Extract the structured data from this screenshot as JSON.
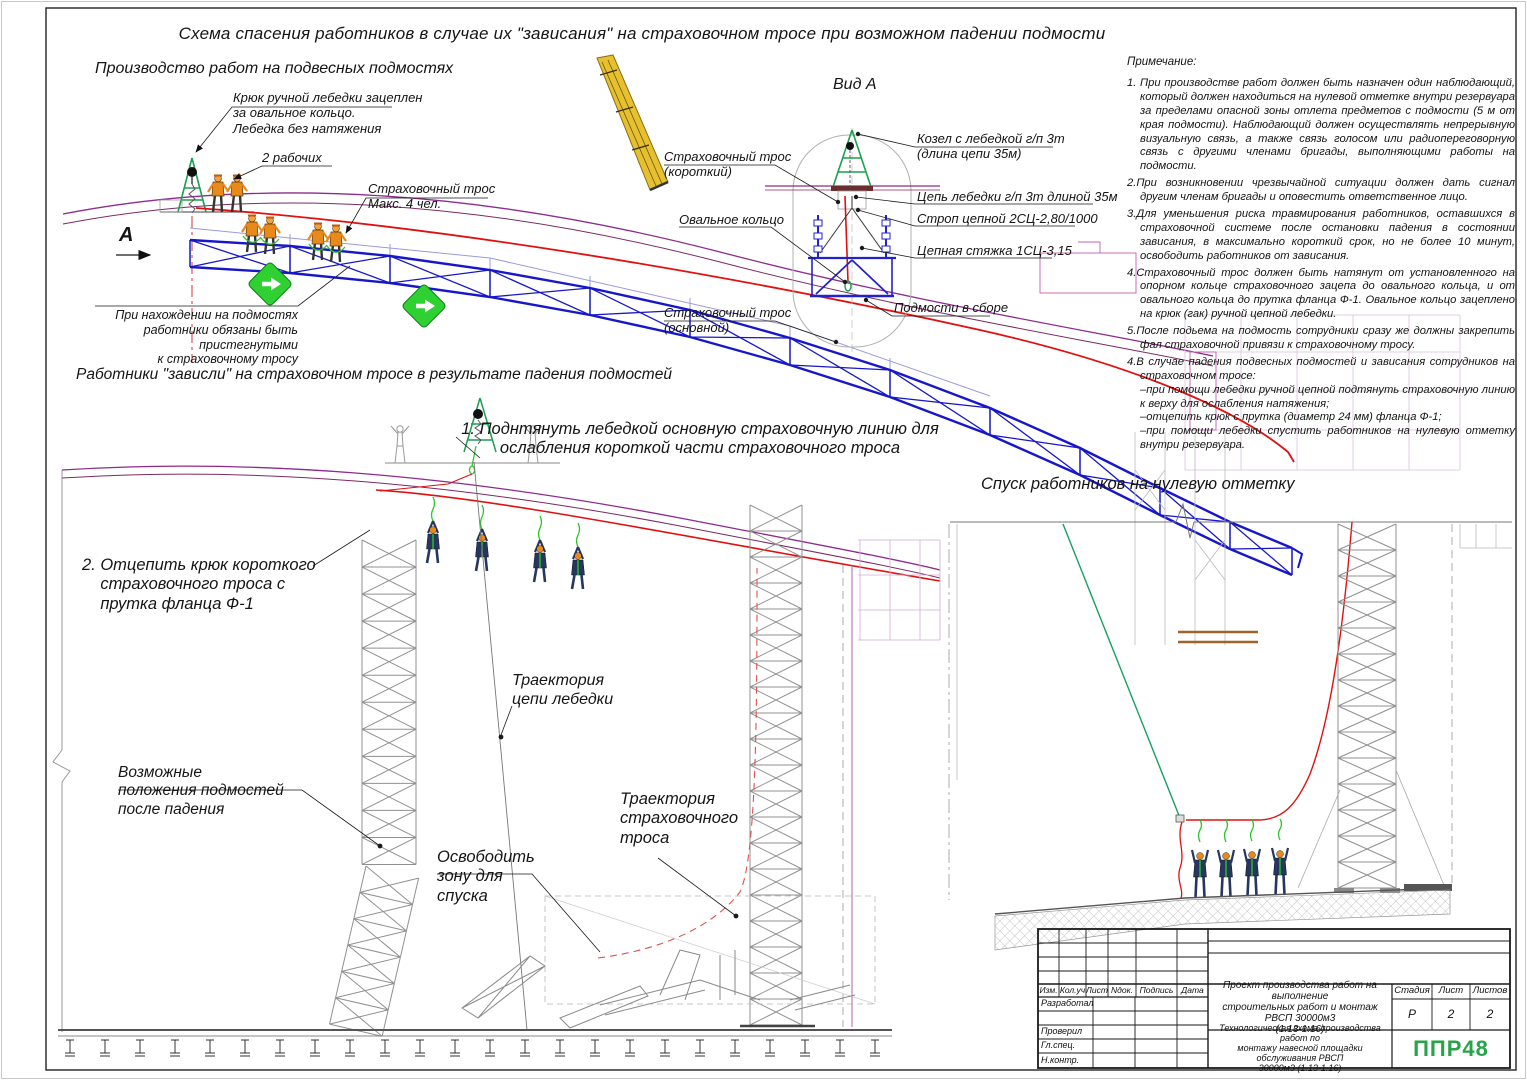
{
  "sheet": {
    "title": "Схема спасения работников в случае их \"зависания\" на страховочном тросе при возможном падении подмости"
  },
  "scene1": {
    "title": "Производство работ на подвесных подмостях",
    "label_hook": "Крюк ручной лебедки зацеплен\nза овальное кольцо.\nЛебедка без натяжения",
    "label_two_workers": "2 рабочих",
    "label_safety_rope": "Страховочный трос\nМакс. 4 чел.",
    "label_attach_note": "При нахождении на подмостях\nработники обязаны быть пристегнутыми\nк страховочному тросу",
    "view_marker": "А"
  },
  "view_a": {
    "title": "Вид А",
    "label_rope_short": "Страховочный трос\n(короткий)",
    "label_ring": "Овальное кольцо",
    "label_rope_main": "Страховочный трос\n(основной)",
    "label_trestle": "Козел с лебедкой г/п 3т\n(длина цепи 35м)",
    "label_chain": "Цепь лебедки г/п 3т длиной 35м",
    "label_sling": "Строп цепной 2СЦ-2,80/1000",
    "label_tie": "Цепная стяжка 1СЦ-3,15",
    "label_assembled": "Подмости в сборе"
  },
  "notes": {
    "title": "Примечание:",
    "items": [
      "1. При производстве работ должен быть назначен один наблюдающий, который должен находиться на нулевой отметке внутри резервуара за пределами опасной зоны отлета предметов с подмости (5 м от края подмости). Наблюдающий должен осуществлять непрерывную визуальную связь, а также связь голосом или радиопереговорную связь с другими членами бригады, выполняющими работы на подмости.",
      "2.При возникновении чрезвычайной ситуации должен дать сигнал другим членам бригады и оповестить ответственное лицо.",
      "3.Для уменьшения риска травмирования работников, оставшихся в страховочной системе после остановки падения в состоянии зависания, в максимально короткий срок, но не более 10 минут, освободить работников от зависания.",
      "4.Страховочный трос должен быть натянут от установленного на опорном кольце страховочного зацепа до овального кольца, и от овального кольца до прутка фланца Ф-1. Овальное кольцо зацеплено на крюк (гак) ручной цепной лебедки.",
      "5.После подьема на подмость сотрудники сразу же должны закрепить фал страховочной привязи к страховочному тросу.",
      "4.В случае падения подвесных подмостей и зависания сотрудников на страховочном тросе:\n–при помощи лебедки ручной цепной подтянуть страховочную линию к верху для ослабления натяжения;\n–отцепить крюк с прутка (диаметр 24 мм) фланца Ф-1;\n–при помощи лебедки спустить работников на нулевую отметку внутри резервуара."
    ]
  },
  "scene2": {
    "title": "Работники \"зависли\" на страховочном тросе в результате падения подмостей",
    "step1": "1. Поднтянуть лебедкой основную страховочную линию для\nослабления короткой части страховочного троса",
    "step2": "2. Отцепить крюк короткого\n    страховочного троса с\n    прутка фланца Ф-1",
    "label_traj_chain": "Траектория\nцепи лебедки",
    "label_positions": "Возможные\nположения подмостей\nпосле падения",
    "label_clear_zone": "Освободить\nзону для\nспуска",
    "label_traj_rope": "Траектория\nстраховочного\nтроса"
  },
  "scene3": {
    "title": "Спуск работников на нулевую отметку"
  },
  "titleblock": {
    "cols": [
      "Изм.",
      "Кол.уч",
      "Лист",
      "Nдок.",
      "Подпись",
      "Дата"
    ],
    "rows": [
      "Разработал",
      "Проверил",
      "Гл.спец.",
      "Н.контр."
    ],
    "project": "Проект производства работ на выполнение\nстроительных работ и монтаж РВСП 30000м3\n(1.13-1.16)",
    "stage_label": "Стадия",
    "sheet_label": "Лист",
    "sheets_label": "Листов",
    "stage": "Р",
    "sheet_no": "2",
    "sheet_total": "2",
    "doc": "Технологическая схема производства работ по\nмонтажу навесной площадки обслуживания РВСП\n30000м3 (1.13-1.16)",
    "logo": "ППР48"
  },
  "colors": {
    "cable_red": "#e01010",
    "truss_blue": "#1717c9",
    "roof_purple": "#8d2b8d",
    "winch_green": "#1d9e4e",
    "lanyard_green": "#2bc42b",
    "sign_green": "#2ed032",
    "worker_orange": "#e8891c",
    "worker_navy": "#26365e",
    "logo_green": "#27a348",
    "crane_yellow": "#e6c02e"
  }
}
